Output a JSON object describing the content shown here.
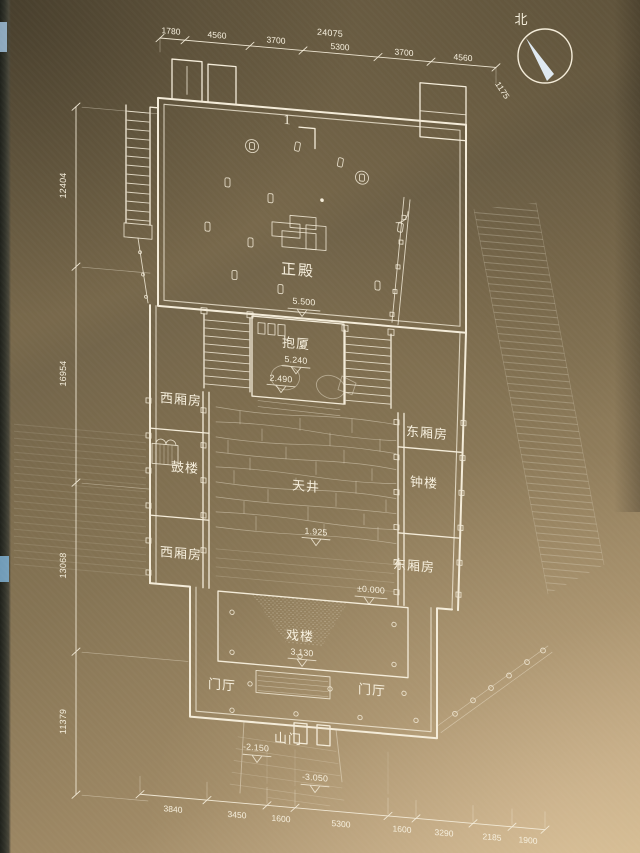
{
  "title": "temple-complex-floor-plan",
  "compass": {
    "label": "北"
  },
  "section_marker": {
    "label": "1"
  },
  "dims": {
    "top": {
      "overall": "24075",
      "segments": [
        "1780",
        "4560",
        "3700",
        "5300",
        "3700",
        "4560"
      ],
      "right_end": "1175"
    },
    "left": [
      "12404",
      "16954",
      "13068",
      "11379"
    ],
    "bottom": [
      "3840",
      "3450",
      "1600",
      "5300",
      "1600",
      "3290",
      "2185",
      "1900"
    ]
  },
  "rooms": {
    "main_hall": "正殿",
    "baoxia": "抱厦",
    "west_wing_upper": "西厢房",
    "drum_tower": "鼓楼",
    "west_wing_lower": "西厢房",
    "east_wing_upper": "东厢房",
    "bell_tower": "钟楼",
    "east_wing_lower": "东厢房",
    "courtyard": "天井",
    "stage": "戏楼",
    "entry_hall_west": "门厅",
    "entry_hall_east": "门厅",
    "mountain_gate": "山门"
  },
  "levels": {
    "main_hall": "5.500",
    "baoxia_upper": "5.240",
    "baoxia_lower": "2.490",
    "courtyard": "1.925",
    "datum": "±0.000",
    "stage": "3.130",
    "gate_upper": "-2.150",
    "gate_lower": "-3.050"
  },
  "colors": {
    "paper_brown": "#84735a",
    "line_ink": "#f4ecd9",
    "compass_needle": "#dfe9f1"
  }
}
